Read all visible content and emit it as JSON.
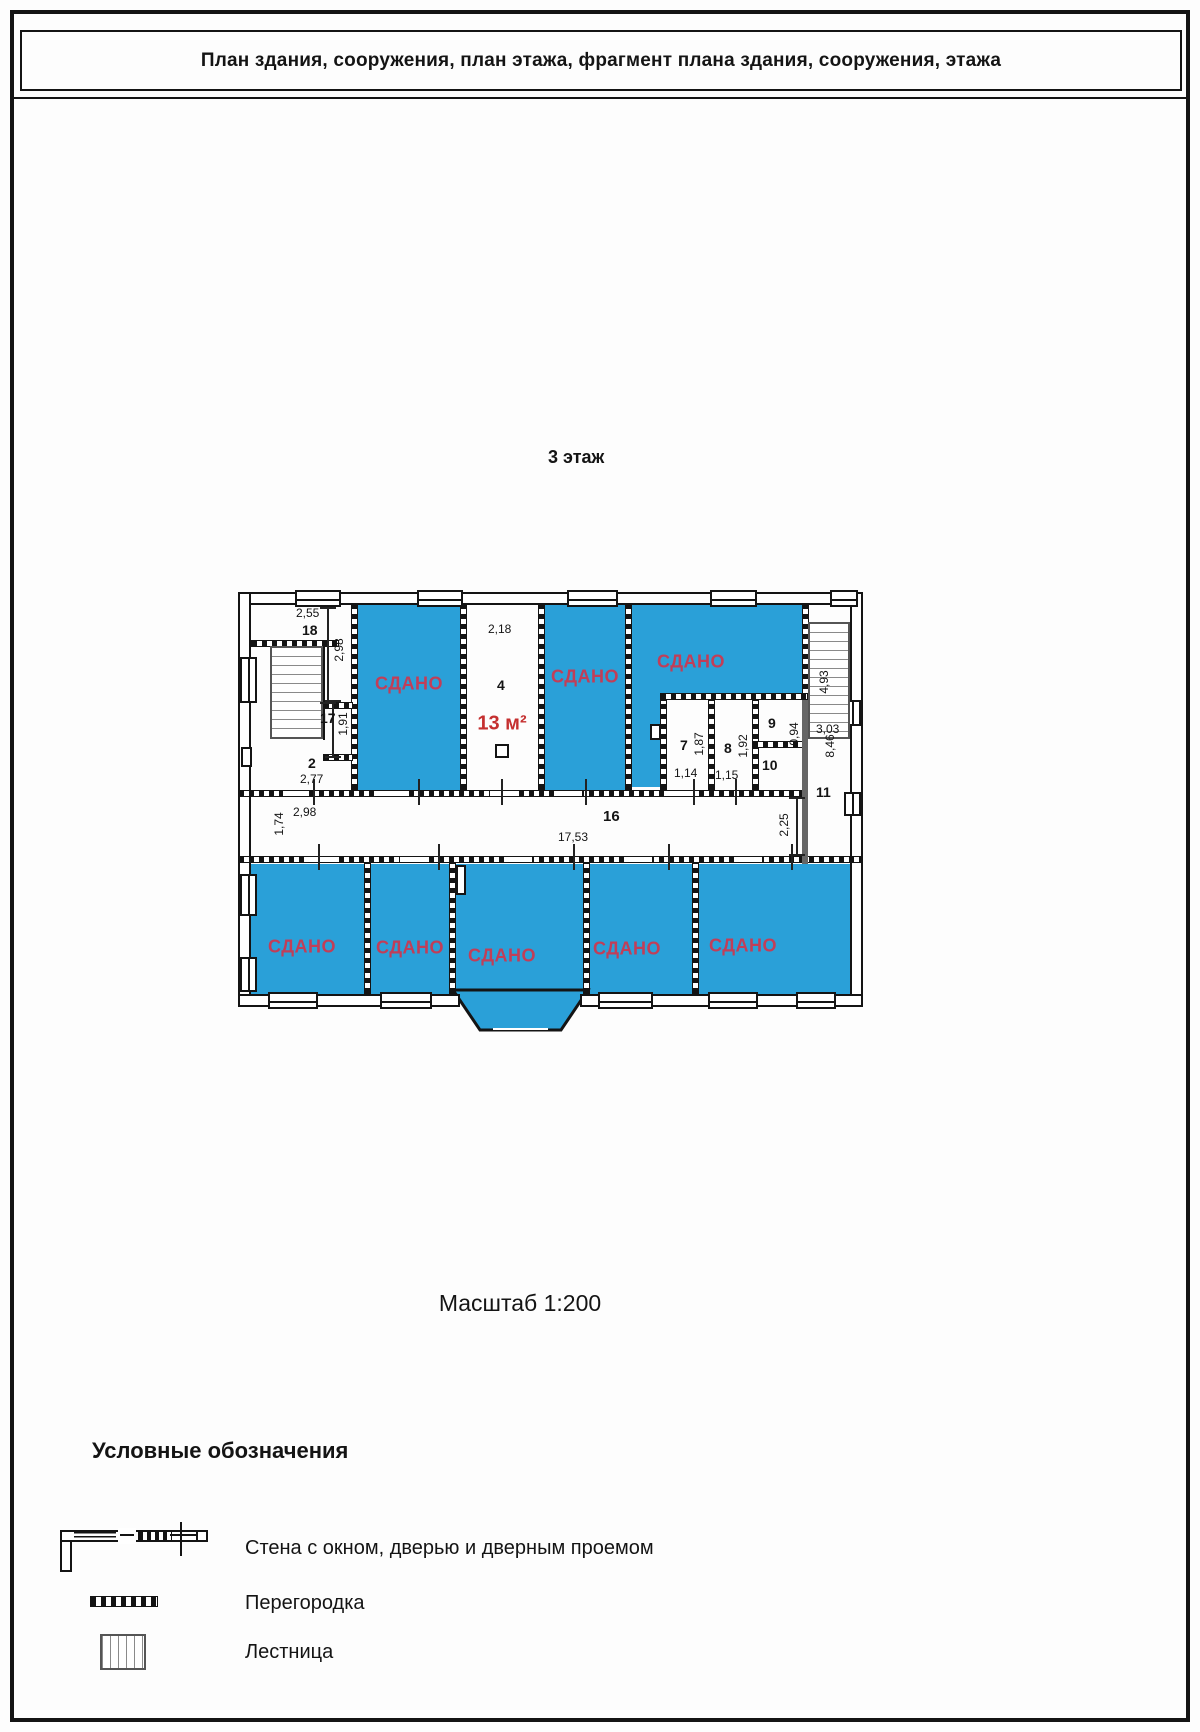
{
  "page": {
    "title": "План здания, сооружения, план этажа, фрагмент плана здания, сооружения, этажа",
    "floor_label": "3 этаж",
    "scale_label": "Масштаб 1:200"
  },
  "legend": {
    "title": "Условные обозначения",
    "wall_item": "Стена с окном, дверью и дверным проемом",
    "partition_item": "Перегородка",
    "stairs_item": "Лестница"
  },
  "plan": {
    "rented_label": "СДАНО",
    "area_label": "13 м²",
    "rooms": {
      "r2": "2",
      "r4": "4",
      "r7": "7",
      "r8": "8",
      "r9": "9",
      "r10": "10",
      "r11": "11",
      "r16": "16",
      "r17": "17",
      "r18": "18"
    },
    "dims": {
      "w255": "2,55",
      "h298": "2,98",
      "h191": "1,91",
      "w277": "2,77",
      "h174": "1,74",
      "w298": "2,98",
      "w218": "2,18",
      "w1753": "17,53",
      "h187": "1,87",
      "w114": "1,14",
      "h192": "1,92",
      "w115": "1,15",
      "h094": "0,94",
      "h846": "8,46",
      "h225": "2,25",
      "h493": "4,93",
      "w303": "3,03"
    },
    "colors": {
      "room_fill": "#2aa0d8",
      "rented_text": "#c13e58",
      "area_text": "#c53030"
    }
  }
}
